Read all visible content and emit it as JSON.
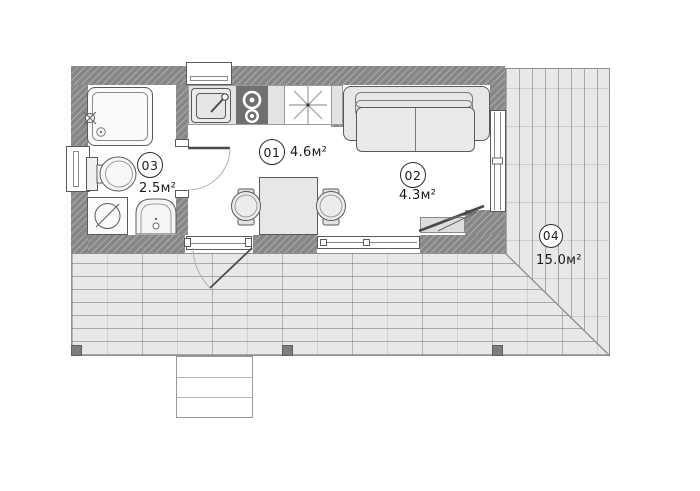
{
  "floor_plan": {
    "rooms": [
      {
        "number": "01",
        "area": "4.6м²"
      },
      {
        "number": "02",
        "area": "4.3м²"
      },
      {
        "number": "03",
        "area": "2.5м²"
      },
      {
        "number": "04",
        "area": "15.0м²"
      }
    ],
    "colors": {
      "wall": "#878787",
      "furniture_fill": "#ececee",
      "deck_fill": "#e8e8ea",
      "outline": "#5a5a5a",
      "stove": "#6f6f6f"
    },
    "icons": [
      "shower-icon",
      "shower-mixer-icon",
      "toilet-icon",
      "washing-machine-icon",
      "washbasin-icon",
      "kitchen-sink-icon",
      "faucet-icon",
      "hob-burner-icon",
      "ceiling-light-icon",
      "sofa-icon",
      "dining-table-icon",
      "chair-icon",
      "door-swing-icon",
      "stairs-icon",
      "deck-post-icon"
    ]
  }
}
